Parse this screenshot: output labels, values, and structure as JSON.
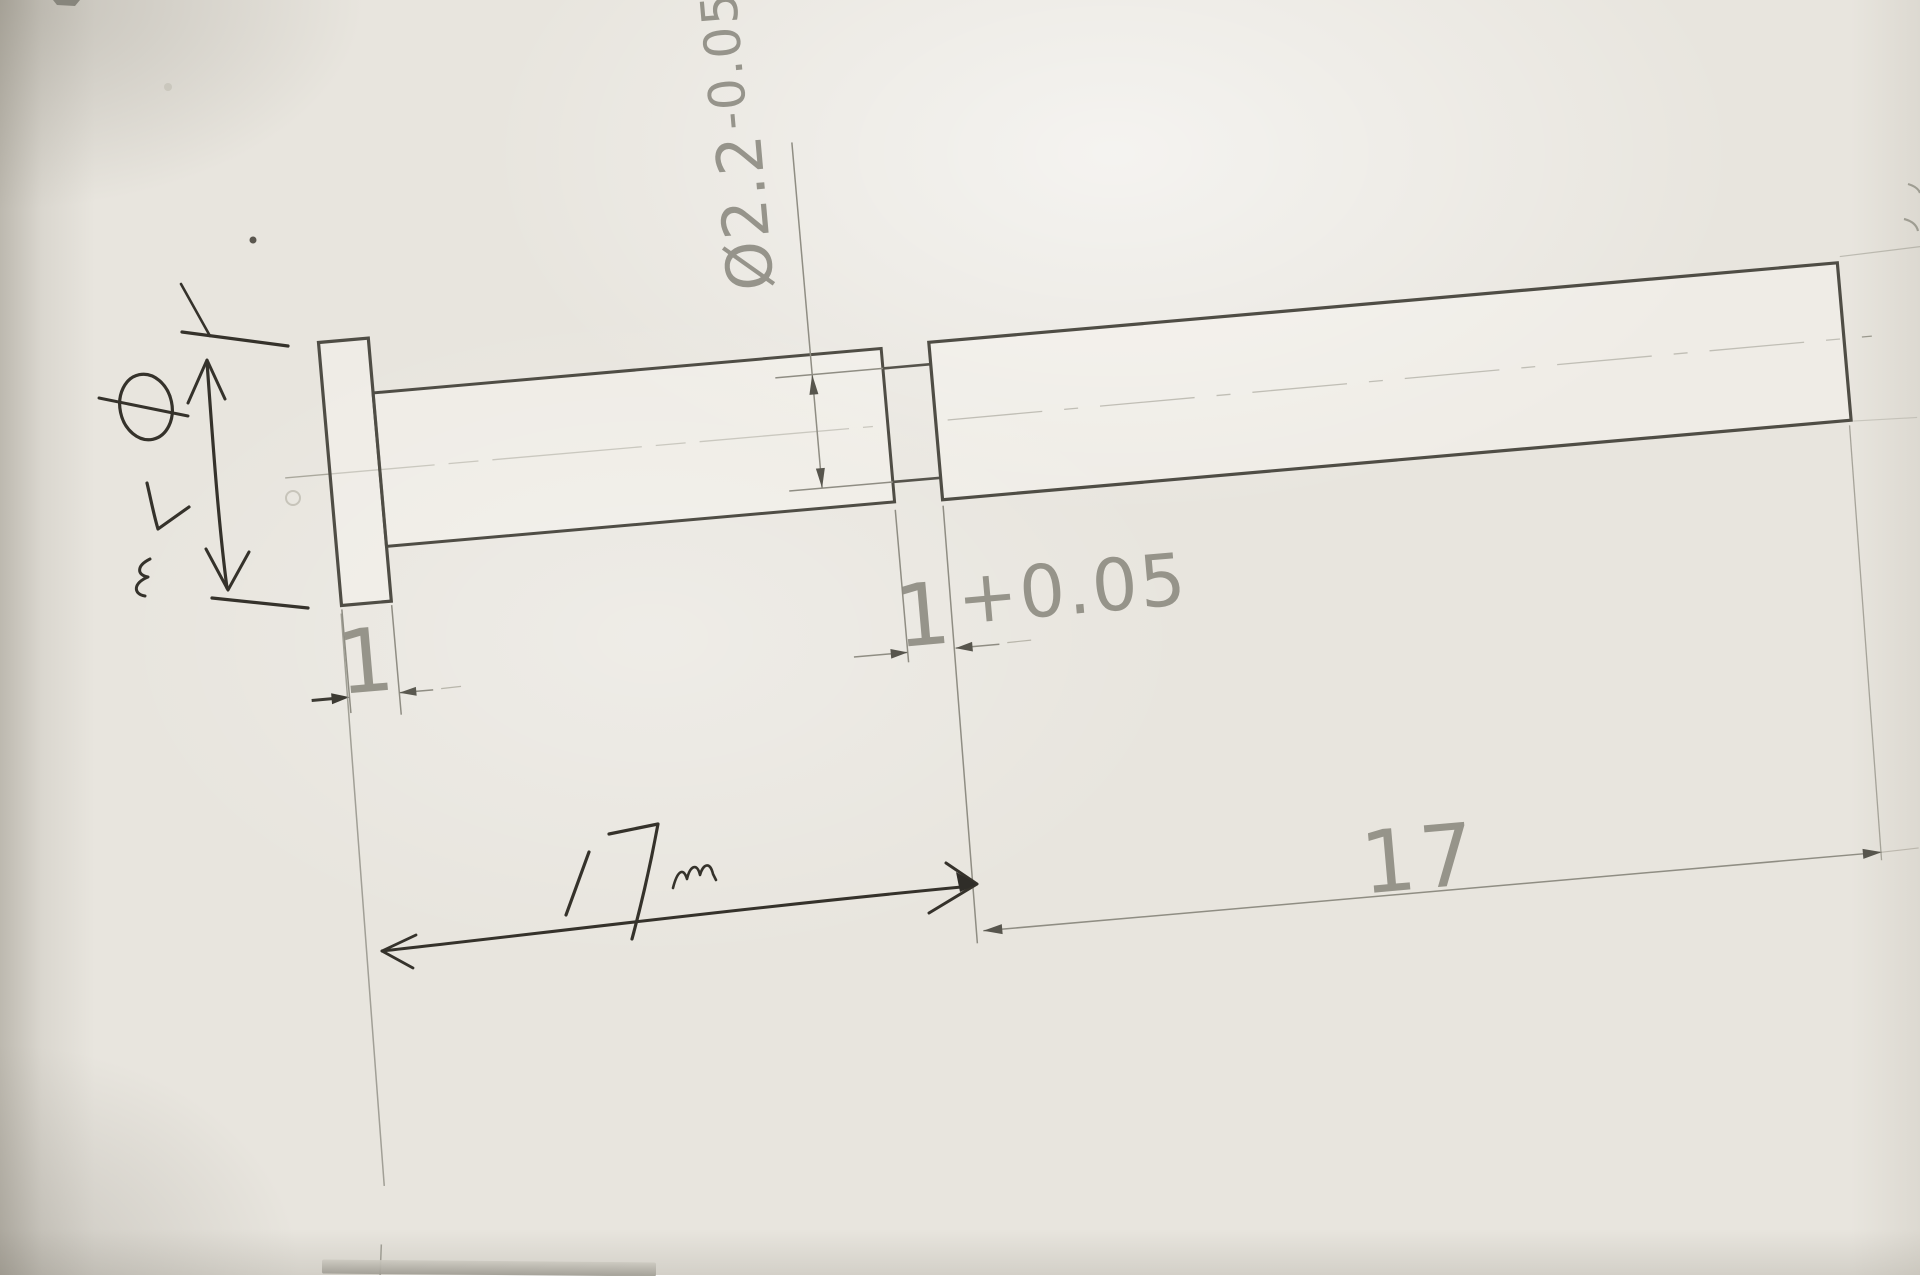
{
  "drawing": {
    "description_labels": {
      "neck_diameter": {
        "value": "Ø2.2",
        "tolerance": "-0.05"
      },
      "flange_thickness": "1",
      "neck_width": {
        "value": "1",
        "tolerance": "+0.05"
      },
      "right_length": "17",
      "handwritten": {
        "flange_diameter": "Ø7",
        "flange_diameter_unit": "m",
        "left_length": "17m"
      }
    },
    "colors": {
      "paper": "#e8e5de",
      "printed_outline": "#4f4d45",
      "thin_line": "#8f8d83",
      "printed_text": "#8b897f",
      "handwritten_ink": "#35322b"
    }
  }
}
